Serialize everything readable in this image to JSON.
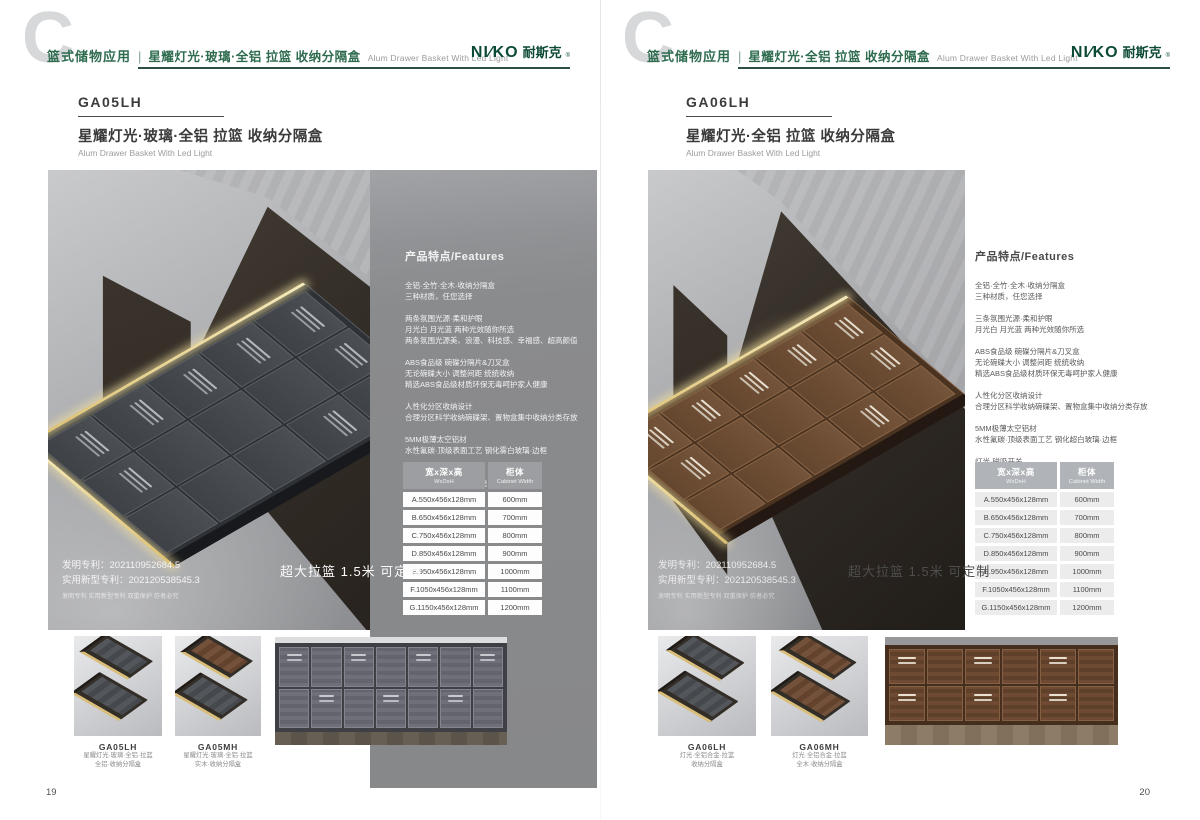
{
  "brand": {
    "text": "NI∕KO",
    "cn": "耐斯克",
    "reg": "®"
  },
  "left": {
    "page_number": "19",
    "header": {
      "watermark": "C",
      "category": "篮式储物应用",
      "separator": "|",
      "subtitle": "星耀灯光·玻璃·全铝 拉篮 收纳分隔盒",
      "subtitle_en": "Alum Drawer Basket With Led Light"
    },
    "product": {
      "code": "GA05LH",
      "title": "星耀灯光·玻璃·全铝 拉篮  收纳分隔盒",
      "title_en": "Alum Drawer Basket With Led Light"
    },
    "features": {
      "heading": "产品特点/Features",
      "groups": [
        [
          "全铝·全竹·全木·收纳分隔盒",
          "三种材质，任您选择"
        ],
        [
          "两条氛围光源·柔和护眼",
          "月光白 月光蓝 两种光效随你所选",
          "两条氛围光源美、浪漫、科技感、幸福感、超高颜值"
        ],
        [
          "ABS食品级 碗碟分隔片&刀叉盒",
          "无论碗碟大小 调整间距 统统收纳",
          "精选ABS食品级材质环保无毒呵护家人健康"
        ],
        [
          "人性化分区收纳设计",
          "合理分区科学收纳碗碟架、置物盒集中收纳分类存放"
        ],
        [
          "5MM极薄太空铝材",
          "水性氟碳·顶级表面工艺 钢化雾白玻璃·边框"
        ],
        [
          "灯光·磁吸开关",
          "拉出·灯亮起 关闭·灯自熄"
        ]
      ]
    },
    "table": {
      "h_size_cn": "宽x深x高",
      "h_size_en": "WxDxH",
      "h_cab_cn": "柜体",
      "h_cab_en": "Cabinet Width",
      "rows": [
        [
          "A.550x456x128mm",
          "600mm"
        ],
        [
          "B.650x456x128mm",
          "700mm"
        ],
        [
          "C.750x456x128mm",
          "800mm"
        ],
        [
          "D.850x456x128mm",
          "900mm"
        ],
        [
          "E.950x456x128mm",
          "1000mm"
        ],
        [
          "F.1050x456x128mm",
          "1100mm"
        ],
        [
          "G.1150x456x128mm",
          "1200mm"
        ]
      ]
    },
    "patent": [
      "发明专利：202110952684.5",
      "实用新型专利：202120538545.3",
      "发明专利 实用新型专利 双重保护 仿者必究"
    ],
    "badge": "超大拉篮 1.5米 可定制",
    "thumbs": [
      {
        "code": "GA05LH",
        "line1": "星耀灯光·玻璃·全铝·拉篮",
        "line2": "全铝·收纳分隔盒"
      },
      {
        "code": "GA05MH",
        "line1": "星耀灯光·玻璃·全铝·拉篮",
        "line2": "实木·收纳分隔盒"
      }
    ]
  },
  "right": {
    "page_number": "20",
    "header": {
      "watermark": "C",
      "category": "篮式储物应用",
      "separator": "|",
      "subtitle": "星耀灯光·全铝 拉篮 收纳分隔盒",
      "subtitle_en": "Alum Drawer Basket With Led Light"
    },
    "product": {
      "code": "GA06LH",
      "title": "星耀灯光·全铝 拉篮 收纳分隔盒",
      "title_en": "Alum Drawer Basket With Led Light"
    },
    "features": {
      "heading": "产品特点/Features",
      "groups": [
        [
          "全铝·全竹·全木·收纳分隔盒",
          "三种材质，任您选择"
        ],
        [
          "三条氛围光源·柔和护眼",
          "月光白 月光蓝 两种光效随你所选"
        ],
        [
          "ABS食品级 碗碟分隔片&刀叉盒",
          "无论碗碟大小 调整间距 统统收纳",
          "精选ABS食品级材质环保无毒呵护家人健康"
        ],
        [
          "人性化分区收纳设计",
          "合理分区科学收纳碗碟架、置物盒集中收纳分类存放"
        ],
        [
          "5MM极薄太空铝材",
          "水性氟碳·顶级表面工艺 钢化超白玻璃·边框"
        ],
        [
          "灯光·磁吸开关",
          "拉出·灯亮起 关闭·灯自熄"
        ]
      ]
    },
    "table": {
      "h_size_cn": "宽x深x高",
      "h_size_en": "WxDxH",
      "h_cab_cn": "柜体",
      "h_cab_en": "Cabinet Width",
      "rows": [
        [
          "A.550x456x128mm",
          "600mm"
        ],
        [
          "B.650x456x128mm",
          "700mm"
        ],
        [
          "C.750x456x128mm",
          "800mm"
        ],
        [
          "D.850x456x128mm",
          "900mm"
        ],
        [
          "E.950x456x128mm",
          "1000mm"
        ],
        [
          "F.1050x456x128mm",
          "1100mm"
        ],
        [
          "G.1150x456x128mm",
          "1200mm"
        ]
      ]
    },
    "patent": [
      "发明专利：202110952684.5",
      "实用新型专利：202120538545.3",
      "发明专利 实用新型专利 双重保护 仿者必究"
    ],
    "badge": "超大拉篮 1.5米 可定制",
    "thumbs": [
      {
        "code": "GA06LH",
        "line1": "灯光·全铝合金·拉篮",
        "line2": "收纳分隔盒"
      },
      {
        "code": "GA06MH",
        "line1": "灯光·全铝合金·拉篮",
        "line2": "全木·收纳分隔盒"
      }
    ]
  },
  "colors": {
    "brand_green": "#2e6b4f",
    "logo_green": "#0d4a35",
    "panel_gray": "#8a8b8d",
    "table_header_gray": "#9d9ea1",
    "led_gold": "#dcc071"
  }
}
